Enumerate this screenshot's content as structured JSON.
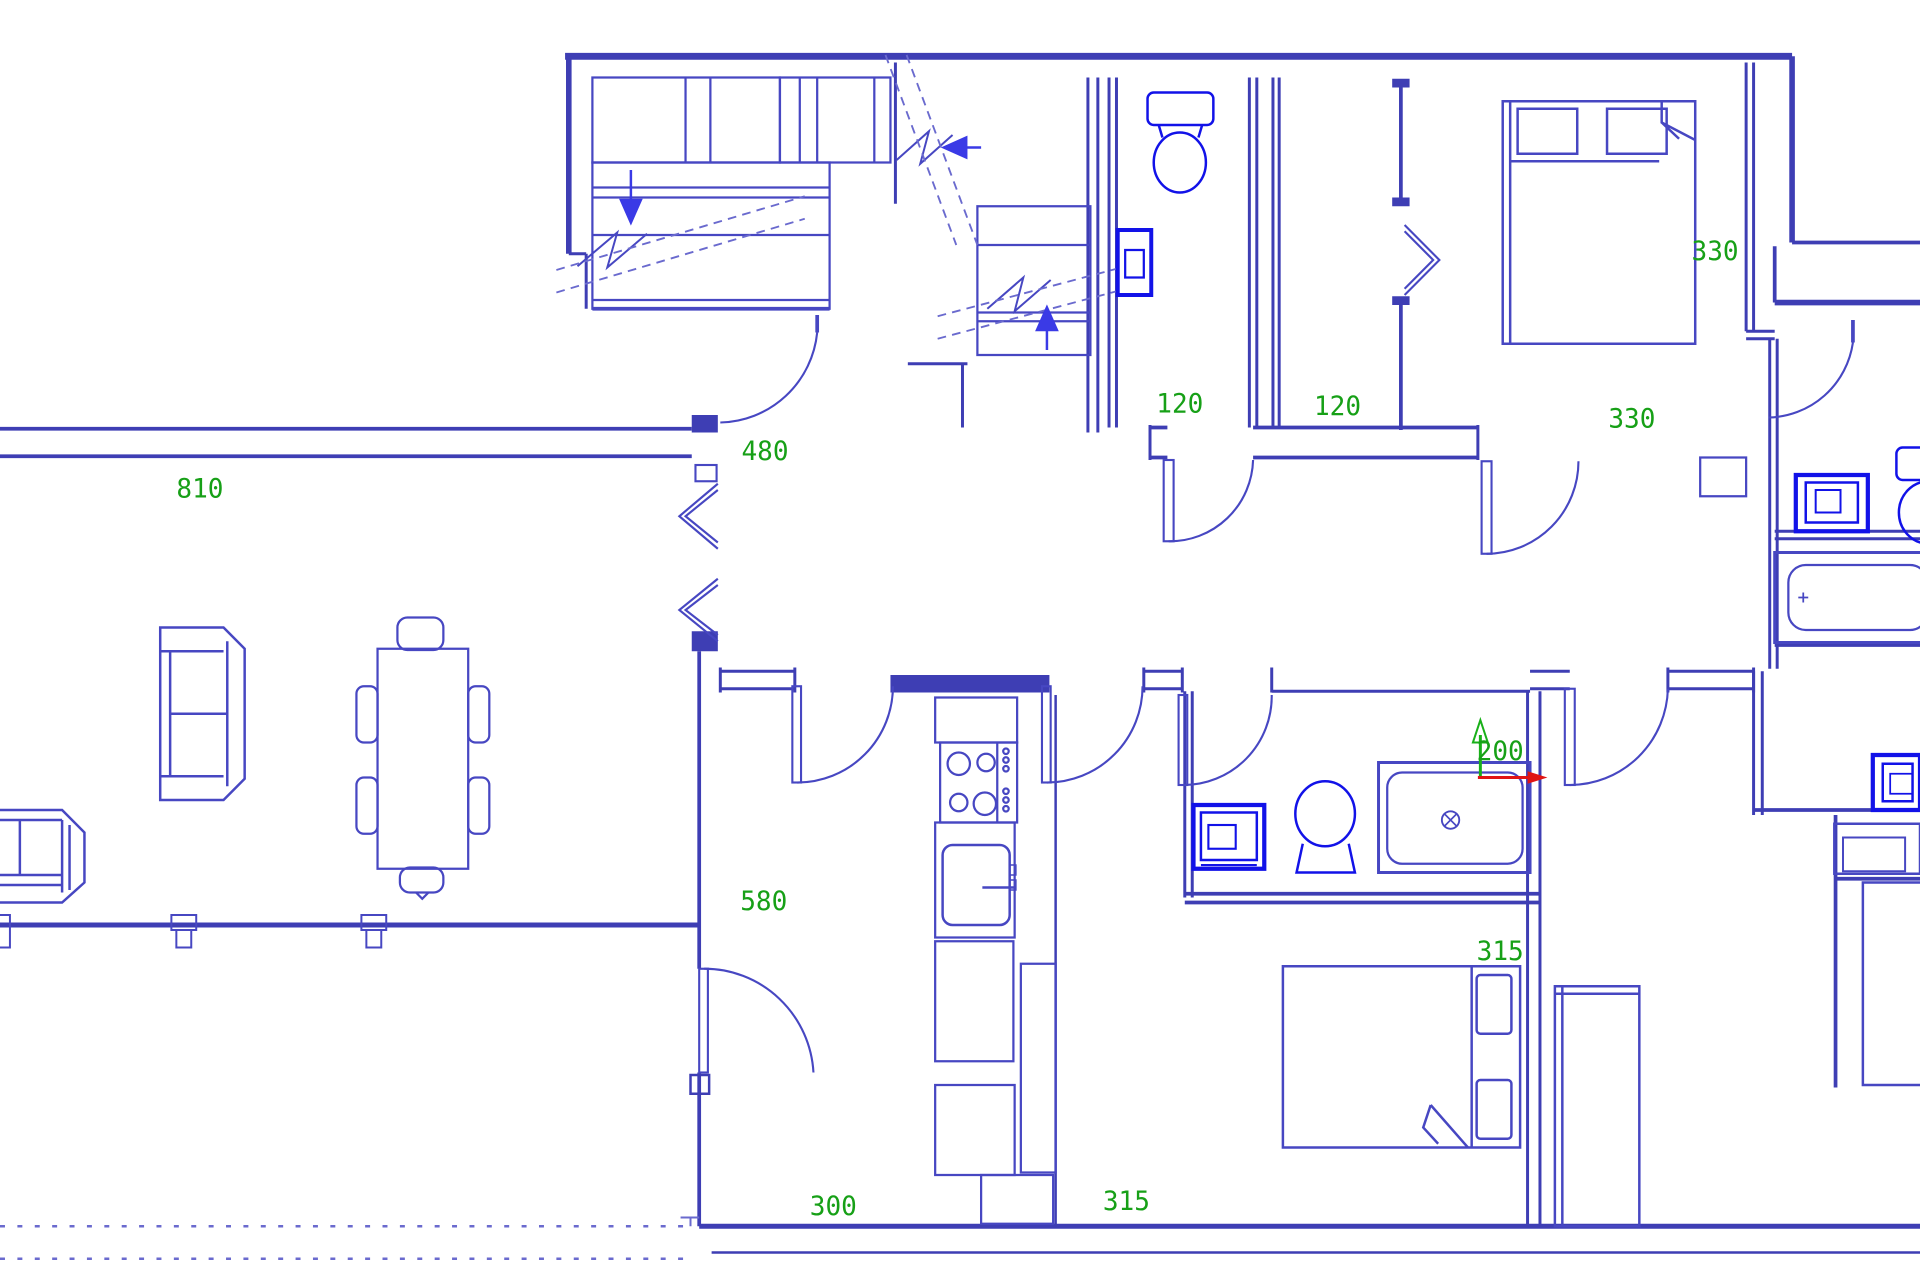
{
  "title": "apartment-floor-plan-cad-drawing",
  "colors": {
    "wall": "#3e3eb4",
    "furniture": "#4747c2",
    "fixture": "#1212e8",
    "label": "#17a017",
    "axis_green": "#19b019",
    "axis_red": "#e01414",
    "dash": "#6a6ace",
    "arrow": "#3a3ae6",
    "background": "#ffffff"
  },
  "ucs_marker": {
    "label": "200",
    "x_axis_color": "red",
    "y_axis_color": "green"
  },
  "dimension_labels": [
    {
      "text": "810",
      "x": 161,
      "y": 398
    },
    {
      "text": "480",
      "x": 616,
      "y": 368
    },
    {
      "text": "120",
      "x": 950,
      "y": 330
    },
    {
      "text": "120",
      "x": 1077,
      "y": 332
    },
    {
      "text": "330",
      "x": 1381,
      "y": 208
    },
    {
      "text": "330",
      "x": 1314,
      "y": 342
    },
    {
      "text": "580",
      "x": 615,
      "y": 728
    },
    {
      "text": "200",
      "x": 1208,
      "y": 608
    },
    {
      "text": "315",
      "x": 1208,
      "y": 768
    },
    {
      "text": "315",
      "x": 907,
      "y": 968
    },
    {
      "text": "300",
      "x": 671,
      "y": 972
    }
  ],
  "fixtures": [
    "staircase-with-break-lines",
    "down-arrow",
    "up-arrow",
    "left-arrow",
    "toilet-wc-room",
    "wall-sink-wc-room",
    "bifold-closet-door",
    "double-bed-top-right",
    "bathroom-sink",
    "bathroom-toilet",
    "bathtub-with-drain",
    "ucs-axis-icon",
    "kitchen-stove-4-burners",
    "kitchen-sink",
    "kitchen-cabinets",
    "refrigerator",
    "sofa-partial",
    "loveseat",
    "dining-table-6-chairs",
    "window-posts",
    "double-bed-bottom",
    "wardrobe",
    "corner-sink-top-right",
    "corner-toilet-partial",
    "bathtub-right",
    "sink-right-partial",
    "dashed-property-line"
  ]
}
